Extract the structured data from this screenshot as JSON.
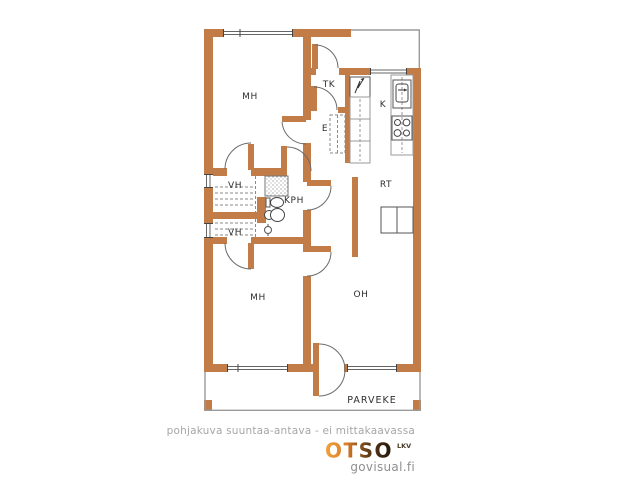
{
  "plan": {
    "rooms": {
      "mh_top": "MH",
      "tk": "TK",
      "k": "K",
      "e": "E",
      "vh_top": "VH",
      "kph": "KPH",
      "rt": "RT",
      "vh_bottom": "VH",
      "mh_bottom": "MH",
      "oh": "OH",
      "parveke": "PARVEKE"
    },
    "fixtures": [
      "shower-icon",
      "washbasin-icon",
      "toilet-icon",
      "floor-drain-icon",
      "electrical-panel-icon",
      "kitchen-cabinets",
      "kitchen-sink-icon",
      "stove-icon",
      "dining-table",
      "closet-shelves",
      "hall-closet"
    ]
  },
  "footer": {
    "disclaimer": "pohjakuva suuntaa-antava - ei mittakaavassa"
  },
  "logo": {
    "brand": "OTSO",
    "suffix": "LKV",
    "site": "govisual.fi"
  },
  "colors": {
    "wall": "#c17c47",
    "line": "#5a5a5a",
    "thin": "#9a9a9a",
    "label": "#2f2f2f",
    "muted": "#a6a6a6",
    "logo_orange": "#eda03c",
    "logo_dark": "#20150c"
  }
}
